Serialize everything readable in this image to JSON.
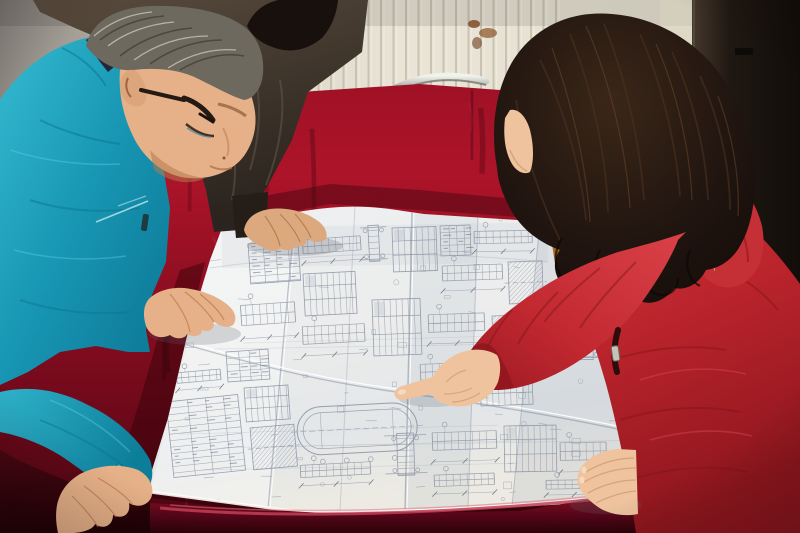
{
  "scene": {
    "description": "Photograph: three people lean over a large folded engineering blueprint spread on a crimson velvet-covered table. On the left an older gray-haired man in a teal work jacket and glasses studies the drawing; behind him a colleague in a dark jacket rests one hand on the sheet; on the right a woman with long dark wavy hair, wearing a red down coat with an orange fur-trimmed hood, points at a detail on the drawing.",
    "setting": "Room with cream vertically-paneled wall, a brown stain on the wall, a dark door at right, and a chrome chair rail peeking above the table edge."
  },
  "people": [
    {
      "id": "worker-left",
      "desc": "older man, gray hair, glasses, teal work jacket, both hands on blueprint"
    },
    {
      "id": "colleague-behind",
      "desc": "person in dark gray-brown jacket, black hair, hand resting on top edge of blueprint"
    },
    {
      "id": "woman-right",
      "desc": "woman, long dark wavy hair, red quilted down coat, orange fur hood trim, pointing with right index finger, left hand on sheet"
    }
  ],
  "objects": {
    "blueprint": {
      "desc": "large white folded construction drawing with beam sections, rebar schedules, dimension lines and a materials table",
      "fold_creases_vertical": 5,
      "fold_creases_horizontal": 2
    },
    "table": {
      "desc": "table draped in crimson velvet"
    },
    "chair": {
      "desc": "chrome-railed chair behind table"
    },
    "door": {
      "desc": "dark brown door on right edge"
    }
  },
  "colors": {
    "wall_cream": "#e9e4d6",
    "wall_gray": "#8b8680",
    "panel_line": "#c3bcaa",
    "stain_brown": "#7a4420",
    "door_dark": "#1f1812",
    "velvet_red": "#9c1024",
    "velvet_dark": "#4a0511",
    "chrome": "#d6d8d2",
    "paper_white": "#f2f2ee",
    "ink_blue_gray": "#8d95a6",
    "teal_jacket": "#1795b2",
    "dark_jacket": "#473b30",
    "black_hair": "#17100d",
    "gray_hair": "#6e695e",
    "red_coat": "#bb242c",
    "fur_orange": "#c97e24",
    "skin_man": "#e6b188",
    "skin_woman": "#eec39e",
    "skin_colleague": "#dca87e"
  },
  "wall": {
    "panel_start_x": 256,
    "panel_spacing": 12.5,
    "panel_line_count": 25,
    "panel_line_bottom": 235
  },
  "blueprint": {
    "seed": 7,
    "scatter_count": 64,
    "long_lines": 6,
    "clusters": [
      {
        "x": 248,
        "y": 244,
        "w": 50,
        "h": 40,
        "type": "table",
        "rot": -4
      },
      {
        "x": 302,
        "y": 236,
        "w": 58,
        "h": 32,
        "type": "beam",
        "rot": -4
      },
      {
        "x": 303,
        "y": 274,
        "w": 52,
        "h": 42,
        "type": "grid",
        "rot": -3
      },
      {
        "x": 360,
        "y": 226,
        "w": 26,
        "h": 36,
        "type": "column",
        "rot": -3
      },
      {
        "x": 392,
        "y": 228,
        "w": 44,
        "h": 44,
        "type": "grid",
        "rot": -2
      },
      {
        "x": 440,
        "y": 226,
        "w": 30,
        "h": 30,
        "type": "table",
        "rot": -2
      },
      {
        "x": 442,
        "y": 262,
        "w": 60,
        "h": 34,
        "type": "beam",
        "rot": -2
      },
      {
        "x": 474,
        "y": 228,
        "w": 58,
        "h": 28,
        "type": "beam",
        "rot": -1
      },
      {
        "x": 508,
        "y": 262,
        "w": 34,
        "h": 42,
        "type": "hatch",
        "rot": -2
      },
      {
        "x": 240,
        "y": 300,
        "w": 54,
        "h": 46,
        "type": "beam",
        "rot": -4
      },
      {
        "x": 302,
        "y": 322,
        "w": 62,
        "h": 40,
        "type": "beam",
        "rot": -3
      },
      {
        "x": 372,
        "y": 300,
        "w": 48,
        "h": 56,
        "type": "grid",
        "rot": -2
      },
      {
        "x": 428,
        "y": 310,
        "w": 56,
        "h": 40,
        "type": "beam",
        "rot": -2
      },
      {
        "x": 492,
        "y": 316,
        "w": 44,
        "h": 36,
        "type": "hatch",
        "rot": -2
      },
      {
        "x": 226,
        "y": 352,
        "w": 42,
        "h": 30,
        "type": "table",
        "rot": -4
      },
      {
        "x": 166,
        "y": 402,
        "w": 72,
        "h": 76,
        "type": "table",
        "rot": -6
      },
      {
        "x": 244,
        "y": 388,
        "w": 44,
        "h": 34,
        "type": "grid",
        "rot": -4
      },
      {
        "x": 250,
        "y": 428,
        "w": 44,
        "h": 42,
        "type": "hatch",
        "rot": -5
      },
      {
        "x": 296,
        "y": 408,
        "w": 120,
        "h": 48,
        "type": "stadium",
        "rot": -3
      },
      {
        "x": 300,
        "y": 462,
        "w": 70,
        "h": 28,
        "type": "beam",
        "rot": -3
      },
      {
        "x": 384,
        "y": 434,
        "w": 42,
        "h": 42,
        "type": "column",
        "rot": -2
      },
      {
        "x": 432,
        "y": 428,
        "w": 64,
        "h": 40,
        "type": "beam",
        "rot": -2
      },
      {
        "x": 434,
        "y": 472,
        "w": 60,
        "h": 26,
        "type": "beam",
        "rot": -2
      },
      {
        "x": 504,
        "y": 426,
        "w": 52,
        "h": 46,
        "type": "grid",
        "rot": -1
      },
      {
        "x": 560,
        "y": 438,
        "w": 46,
        "h": 40,
        "type": "beam",
        "rot": -1
      },
      {
        "x": 546,
        "y": 478,
        "w": 56,
        "h": 20,
        "type": "beam",
        "rot": -1
      },
      {
        "x": 420,
        "y": 360,
        "w": 52,
        "h": 36,
        "type": "beam",
        "rot": -2
      },
      {
        "x": 480,
        "y": 374,
        "w": 52,
        "h": 32,
        "type": "grid",
        "rot": -2
      },
      {
        "x": 560,
        "y": 298,
        "w": 46,
        "h": 62,
        "type": "column",
        "rot": -1
      },
      {
        "x": 176,
        "y": 370,
        "w": 44,
        "h": 24,
        "type": "beam",
        "rot": -5
      }
    ]
  },
  "texture": {
    "velvet_streaks": 34,
    "velvet_highlights": 14,
    "fur_spikes": 46
  }
}
